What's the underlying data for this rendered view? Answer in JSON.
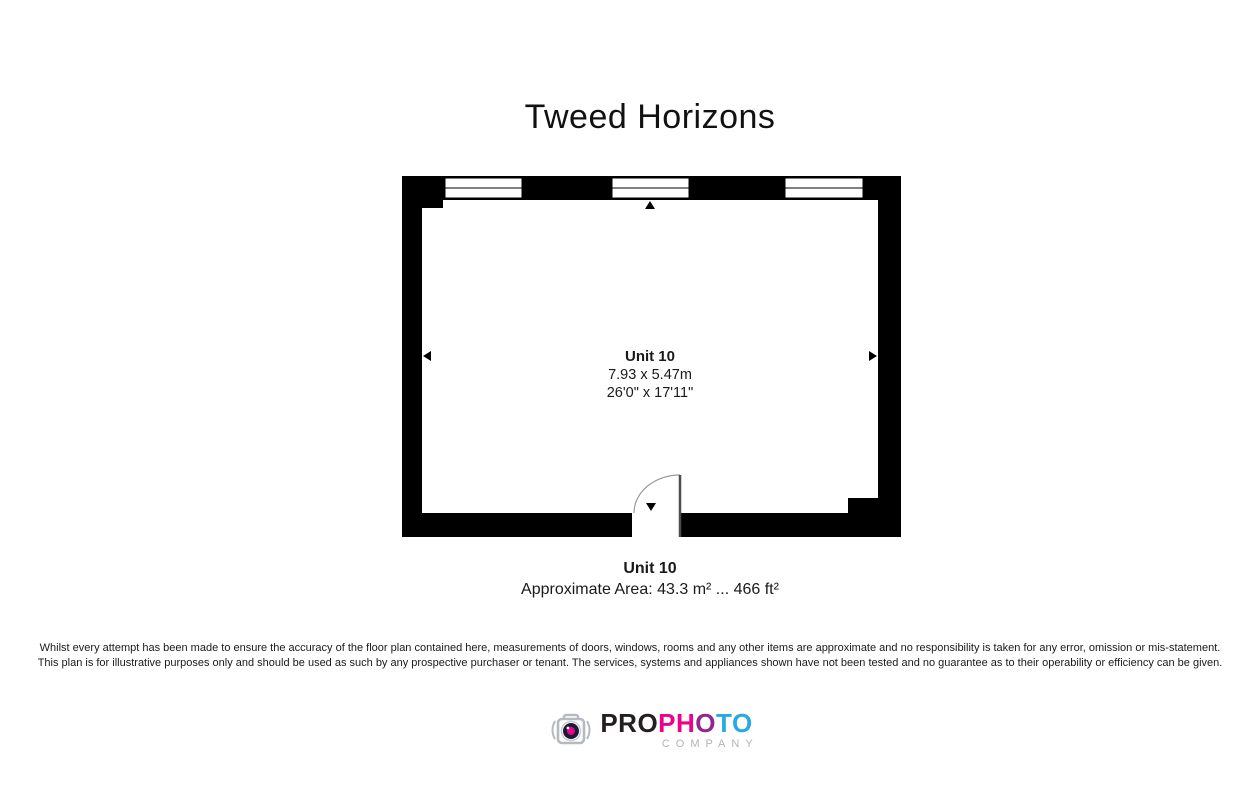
{
  "page": {
    "title": "Tweed Horizons"
  },
  "floor_plan": {
    "room": {
      "name": "Unit 10",
      "dimensions_metric": "7.93 x 5.47m",
      "dimensions_imperial": "26'0\" x 17'11\""
    },
    "features": {
      "window_count": 3,
      "door": "quarter-swing door, bottom center",
      "direction_markers": [
        "up",
        "down",
        "left",
        "right"
      ]
    },
    "wall_color": "#000000"
  },
  "summary": {
    "unit_name": "Unit 10",
    "area_text": "Approximate Area: 43.3 m² ... 466 ft²"
  },
  "disclaimer": {
    "line1": "Whilst every attempt has been made to ensure the accuracy of the floor plan contained here, measurements of doors, windows, rooms and any other items are approximate and no responsibility is taken for any error, omission or mis-statement.",
    "line2": "This plan is for illustrative purposes only and should be used as such by any prospective purchaser or tenant. The services, systems and appliances shown have not been tested and no guarantee as to their operability or efficiency can be given."
  },
  "logo": {
    "icon": "camera-icon",
    "brand_segments": [
      {
        "text": "PRO",
        "color": "#231f20"
      },
      {
        "text": "PH",
        "color": "#ec008c"
      },
      {
        "text": "O",
        "color": "#92278f"
      },
      {
        "text": "TO",
        "color": "#27aae1"
      }
    ],
    "subtitle": "COMPANY",
    "subtitle_color": "#b3b3b3",
    "icon_colors": {
      "body": "#b5bac0",
      "lens": "#1b1b35",
      "lens_center": "#ec008c"
    }
  }
}
